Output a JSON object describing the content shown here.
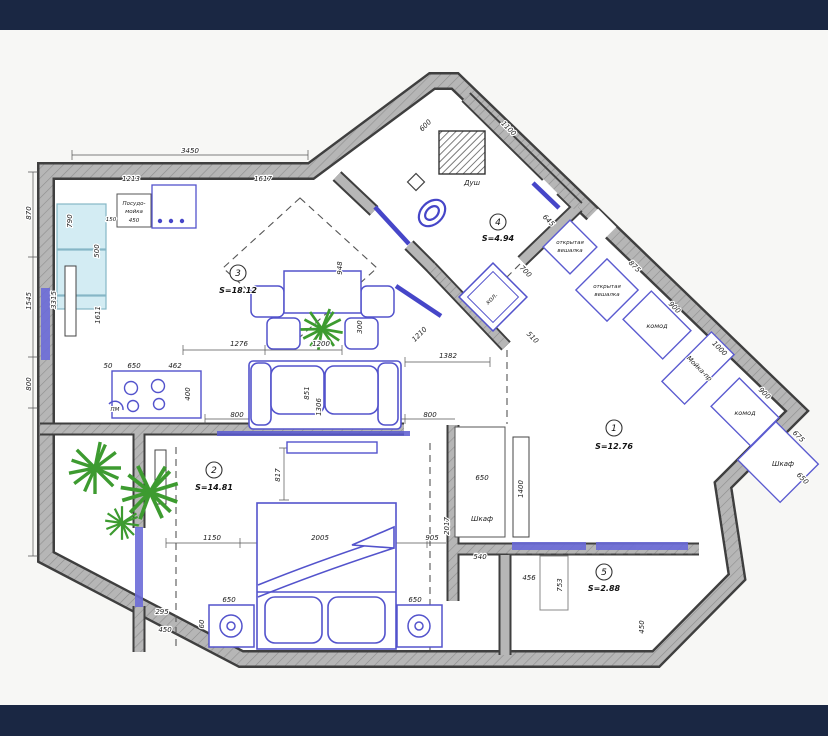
{
  "viewer": {
    "top_bar_color": "#1a2743",
    "bottom_bar_color": "#1a2743",
    "canvas_bg": "#f7f7f5"
  },
  "plan": {
    "colors": {
      "walls": "#b6b6b6",
      "wall_edges": "#3f3f3f",
      "furniture_blue": "#5353cc",
      "kitchen_counter_cyan": "#d3ecf3",
      "plant_green": "#3d9b30"
    },
    "rooms": [
      {
        "number": "3",
        "area": "S=18.12"
      },
      {
        "number": "2",
        "area": "S=14.81"
      },
      {
        "number": "1",
        "area": "S=12.76"
      },
      {
        "number": "4",
        "area": "S=4.94"
      },
      {
        "number": "5",
        "area": "S=2.88"
      }
    ],
    "labels": {
      "shower": "Душ",
      "sink_cabinet": [
        "Посудо-",
        "мойка",
        "450"
      ],
      "fridge": "хол.",
      "open_hanger": [
        "открытая",
        "вешалка"
      ],
      "dresser": "комод",
      "hall_unit": "Мойка-пр",
      "wardrobe": "Шкаф",
      "stove_mark": "ПМ"
    },
    "dimensions": [
      "3450",
      "1213",
      "1617",
      "600",
      "1100",
      "870",
      "1545",
      "800",
      "3315",
      "790",
      "500",
      "1611",
      "150",
      "50",
      "650",
      "462",
      "400",
      "800",
      "800",
      "851",
      "1306",
      "1276",
      "1200",
      "948",
      "300",
      "1150",
      "2005",
      "905",
      "817",
      "295",
      "450",
      "650",
      "650",
      "60",
      "1210",
      "1382",
      "510",
      "700",
      "645",
      "875",
      "900",
      "1000",
      "900",
      "675",
      "650",
      "650",
      "540",
      "1400",
      "2017",
      "456",
      "753",
      "450"
    ]
  }
}
